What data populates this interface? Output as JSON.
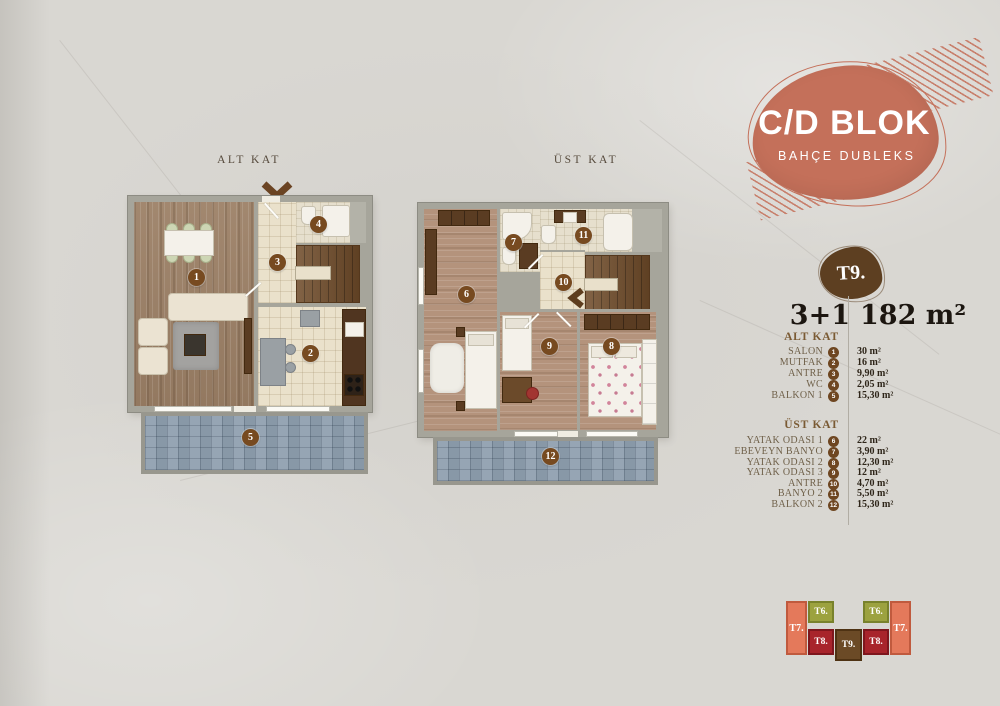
{
  "header": {
    "block": "C/D BLOK",
    "subtitle": "BAHÇE DUBLEKS"
  },
  "plans": {
    "alt": {
      "title": "ALT KAT",
      "badges": [
        "1",
        "3",
        "4",
        "2",
        "5"
      ]
    },
    "ust": {
      "title": "ÜST KAT",
      "badges": [
        "6",
        "7",
        "11",
        "10",
        "9",
        "8",
        "12"
      ]
    }
  },
  "unit": {
    "badge": "T9.",
    "type": "3+1",
    "area": "182 m²"
  },
  "legend": {
    "alt": {
      "title": "ALT KAT",
      "rows": [
        {
          "label": "SALON",
          "n": "1",
          "value": "30 m²"
        },
        {
          "label": "MUTFAK",
          "n": "2",
          "value": "16 m²"
        },
        {
          "label": "ANTRE",
          "n": "3",
          "value": "9,90 m²"
        },
        {
          "label": "WC",
          "n": "4",
          "value": "2,05 m²"
        },
        {
          "label": "BALKON 1",
          "n": "5",
          "value": "15,30 m²"
        }
      ]
    },
    "ust": {
      "title": "ÜST KAT",
      "rows": [
        {
          "label": "YATAK ODASI 1",
          "n": "6",
          "value": "22 m²"
        },
        {
          "label": "EBEVEYN BANYO",
          "n": "7",
          "value": "3,90 m²"
        },
        {
          "label": "YATAK ODASI 2",
          "n": "8",
          "value": "12,30 m²"
        },
        {
          "label": "YATAK ODASI 3",
          "n": "9",
          "value": "12 m²"
        },
        {
          "label": "ANTRE",
          "n": "10",
          "value": "4,70 m²"
        },
        {
          "label": "BANYO 2",
          "n": "11",
          "value": "5,50 m²"
        },
        {
          "label": "BALKON 2",
          "n": "12",
          "value": "15,30 m²"
        }
      ]
    }
  },
  "siteplan": {
    "blocks": [
      {
        "label": "T7."
      },
      {
        "label": "T6."
      },
      {
        "label": "T8."
      },
      {
        "label": "T9."
      },
      {
        "label": "T8."
      },
      {
        "label": "T6."
      },
      {
        "label": "T7."
      }
    ]
  },
  "colors": {
    "accent_salmon": "#c4705a",
    "unit_badge_brown": "#5d3f21",
    "plan_badge_brown": "#774a20",
    "t6_green": "#9ca23f",
    "t7_salmon": "#e4795b",
    "t8_red": "#a8242b",
    "t9_brown": "#6b4a26",
    "balcony_tile": "#8e9eae",
    "background": "#d9d7d2"
  }
}
